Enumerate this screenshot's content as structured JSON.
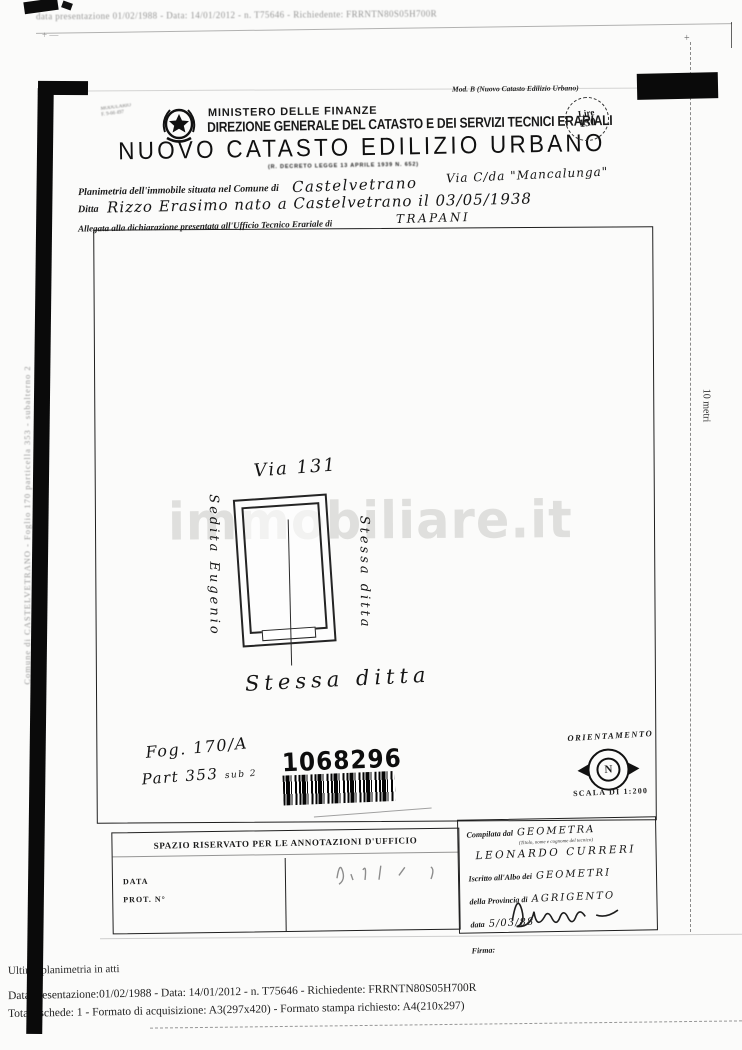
{
  "scan": {
    "top_line": "data presentazione 01/02/1988 - Data: 14/01/2012 - n. T75646 - Richiedente: FRRNTN80S05H700R",
    "left_margin_line1": "Comune di CASTELVETRANO - Foglio 170 particella 353 - subalterno 2",
    "left_margin_line2": "CONTRADA MANICALUNGA STRADA 130 piano: T:",
    "right_margin_scale": "10 metri"
  },
  "header": {
    "mod_b": "Mod. B (Nuovo Catasto Edilizio Urbano)",
    "modulario_line1": "MODULARIO",
    "modulario_line2": "F. 9-66 497",
    "ministero": "MINISTERO DELLE FINANZE",
    "direzione": "DIREZIONE GENERALE DEL CATASTO E DEI SERVIZI TECNICI ERARIALI",
    "title": "NUOVO CATASTO EDILIZIO URBANO",
    "decreto": "(R. DECRETO LEGGE 13 APRILE 1939 N. 652)",
    "stamp_line1": "Lire",
    "stamp_line2": "150"
  },
  "form": {
    "line1_label": "Planimetria dell'immobile situata nel Comune di",
    "line1_value": "Castelvetrano",
    "via_value": "Via C/da \"Mancalunga\"",
    "line2_label": "Ditta",
    "line2_value": "Rizzo Erasimo nato a Castelvetrano il 03/05/1938",
    "line3_label": "Allegata alla dichiarazione presentata all'Ufficio Tecnico Erariale di",
    "line3_value": "TRAPANI"
  },
  "drawing": {
    "via_label": "Via 131",
    "left_neighbor": "Sedita Eugenio",
    "right_neighbor": "Stessa ditta",
    "bottom_neighbor": "Stessa ditta",
    "foglio": "Fog. 170/A",
    "particella": "Part 353",
    "sub": "sub 2",
    "barcode_number": "1068296",
    "orientamento_label": "ORIENTAMENTO",
    "compass_letter": "N",
    "scala_label": "SCALA DI 1:200"
  },
  "watermark": {
    "text": "immobiliare.it"
  },
  "annotations": {
    "header": "SPAZIO RISERVATO PER LE ANNOTAZIONI D'UFFICIO",
    "data_label": "DATA",
    "prot_label": "PROT. N°"
  },
  "compiler": {
    "compilata_label": "Compilata dal",
    "compilata_value": "GEOMETRA",
    "subtitle": "(Titolo, nome e cognome del tecnico)",
    "name": "LEONARDO CURRERI",
    "iscritto_label": "Iscritto all'Albo dei",
    "iscritto_value": "GEOMETRI",
    "provincia_label": "della Provincia di",
    "provincia_value": "AGRIGENTO",
    "data_label": "data",
    "data_value": "5/03/88",
    "firma_label": "Firma:"
  },
  "footer": {
    "line1": "Ultima planimetria in atti",
    "line2": "Data presentazione:01/02/1988 - Data: 14/01/2012 - n. T75646 - Richiedente: FRRNTN80S05H700R",
    "line3": "Totale schede: 1 - Formato di acquisizione: A3(297x420)  - Formato stampa richiesto: A4(210x297)"
  }
}
